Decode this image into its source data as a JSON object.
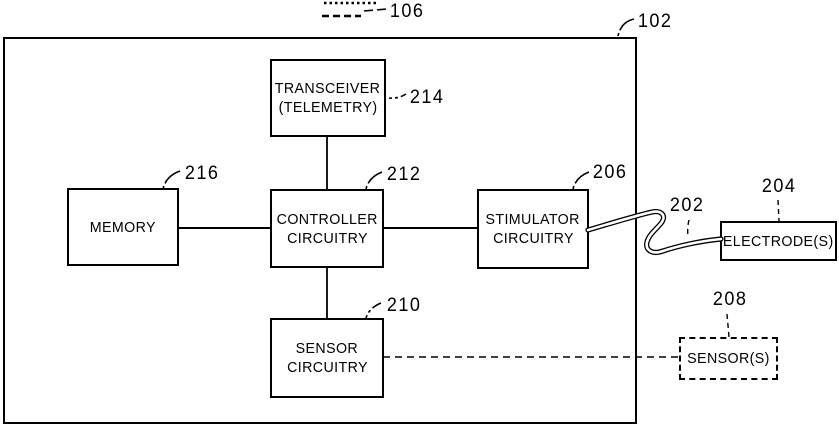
{
  "figure": {
    "colors": {
      "ink": "#000000",
      "background": "#ffffff"
    },
    "refs": {
      "header": "106",
      "device": "102",
      "transceiver": "214",
      "memory": "216",
      "controller": "212",
      "stimulator": "206",
      "sensor_circuitry": "210",
      "lead": "202",
      "electrodes": "204",
      "sensors": "208"
    },
    "boxes": {
      "transceiver": {
        "line1": "TRANSCEIVER",
        "line2": "(TELEMETRY)"
      },
      "memory": {
        "line1": "MEMORY"
      },
      "controller": {
        "line1": "CONTROLLER",
        "line2": "CIRCUITRY"
      },
      "stimulator": {
        "line1": "STIMULATOR",
        "line2": "CIRCUITRY"
      },
      "sensor_circuitry": {
        "line1": "SENSOR",
        "line2": "CIRCUITRY"
      },
      "electrodes": {
        "line1": "ELECTRODE(S)"
      },
      "sensors": {
        "line1": "SENSOR(S)"
      }
    }
  }
}
